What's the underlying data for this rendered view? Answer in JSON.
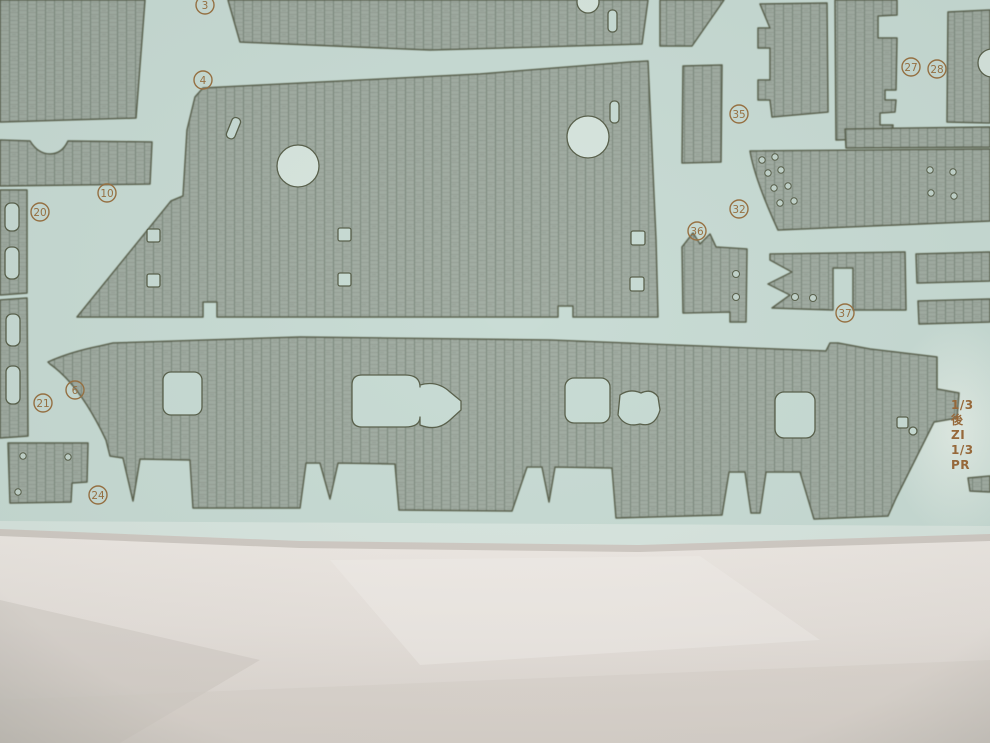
{
  "scene": {
    "subject": "photo of a model-kit textured decal sheet with numbered deck/hull pieces on white paper"
  },
  "colors": {
    "sheet": "#c9dcd5",
    "sheet_light": "#d8e6df",
    "piece_fill": "#a3aea4",
    "piece_line_v": "#7e8a7e",
    "piece_line_h": "#909b8e",
    "outline": "#5b624d",
    "callout": "#9a7344",
    "paper": "#ece7e2",
    "paper_shadow": "#d3ccc6"
  },
  "callouts": [
    {
      "n": "3",
      "x": 205,
      "y": 5
    },
    {
      "n": "4",
      "x": 203,
      "y": 80
    },
    {
      "n": "10",
      "x": 107,
      "y": 193
    },
    {
      "n": "20",
      "x": 40,
      "y": 212
    },
    {
      "n": "27",
      "x": 911,
      "y": 67
    },
    {
      "n": "28",
      "x": 937,
      "y": 69
    },
    {
      "n": "35",
      "x": 739,
      "y": 114
    },
    {
      "n": "32",
      "x": 739,
      "y": 209
    },
    {
      "n": "36",
      "x": 697,
      "y": 231
    },
    {
      "n": "37",
      "x": 845,
      "y": 313
    },
    {
      "n": "6",
      "x": 75,
      "y": 390
    },
    {
      "n": "21",
      "x": 43,
      "y": 403
    },
    {
      "n": "24",
      "x": 98,
      "y": 495
    }
  ],
  "side_text": {
    "lines": [
      "1/3",
      "後",
      "ZI",
      "1/3",
      "PR"
    ]
  }
}
